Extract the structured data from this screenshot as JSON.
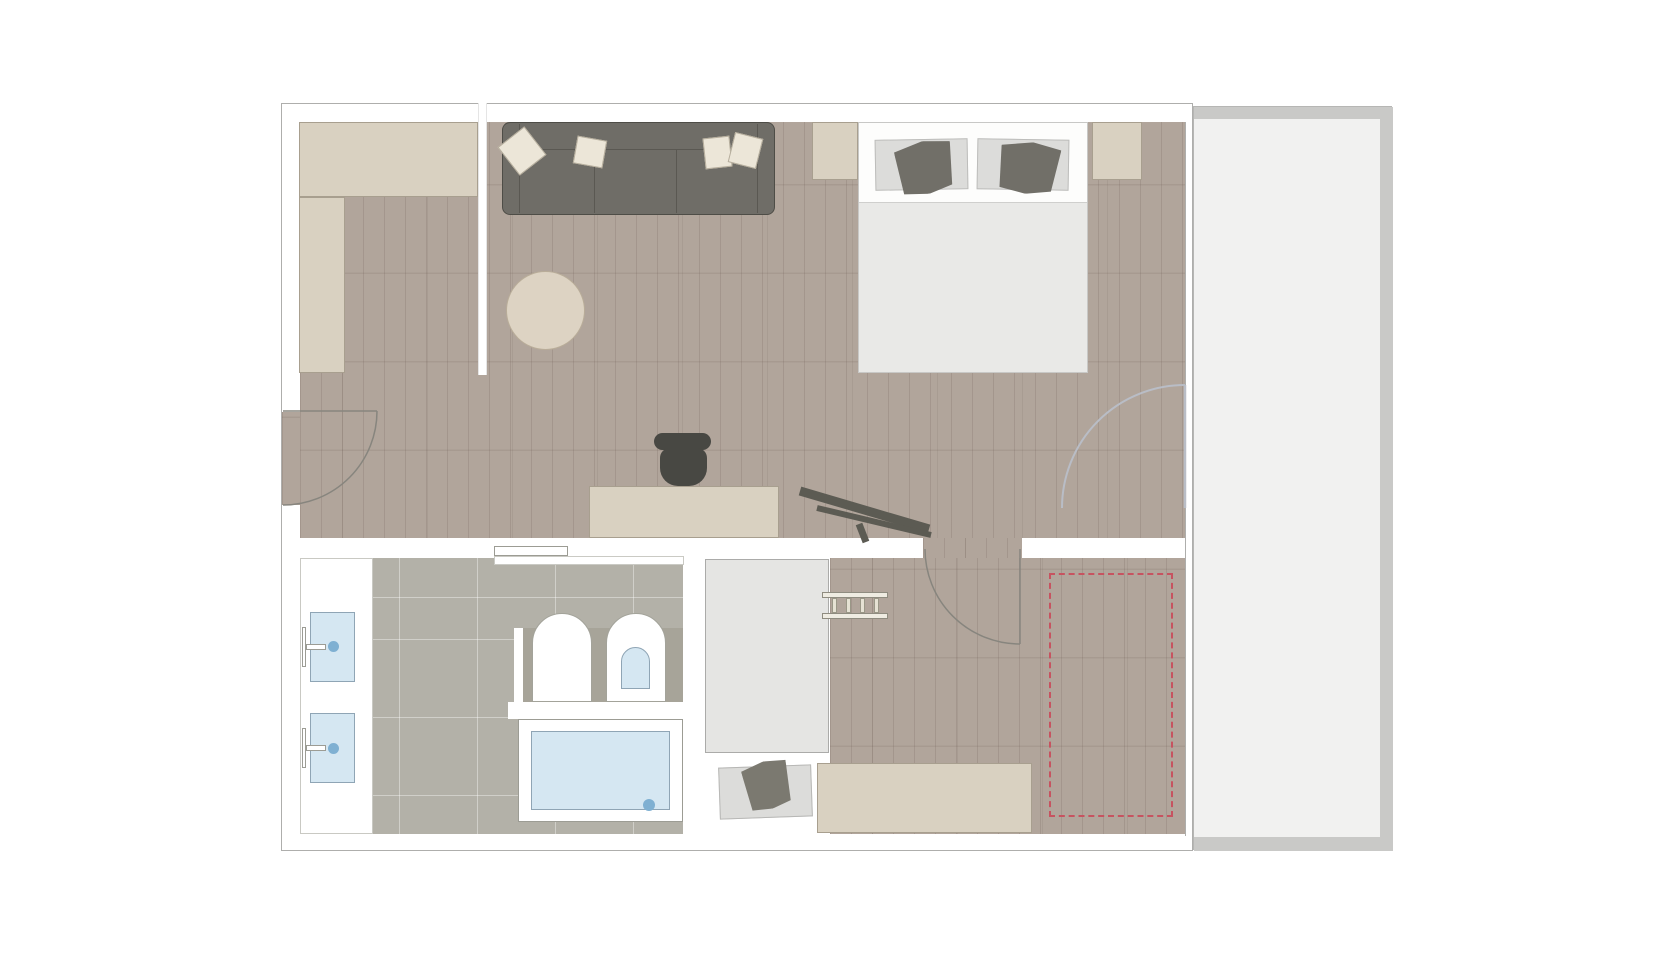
{
  "document": {
    "type": "floor-plan",
    "description": "Top-down architectural floor plan of a one-bedroom suite with living area, bedroom, bathroom, dressing hallway and a full-height balcony on the right; no text labels are rendered in the image."
  },
  "palette": {
    "wall-line": "#aeaeac",
    "wood": "#b1a59b",
    "tile": "#b3b1a8",
    "balcony-floor": "#f1f1f0",
    "railing": "#c9c9c7",
    "beige": "#d9d1c1",
    "beige-line": "#a89f8f",
    "sofa": "#6f6d67",
    "sofa-line": "#4e4d47",
    "pillow-light": "#ece6d8",
    "accent-pillow": "#716f68",
    "bed-white": "#fdfdfc",
    "duvet": "#e9e9e7",
    "pillow-gray": "#dcdcda",
    "water": "#d5e7f2",
    "water-line": "#8fa5b5",
    "drain": "#7fb0d2",
    "fixture-line": "#9c9c94",
    "toilet-block": "#a7a499",
    "chair-dark": "#484843",
    "wardrobe": "#e5e5e3",
    "rug-gray": "#dcdcda",
    "pet-pillow": "#7b7970",
    "rug-round": "#ddd3c3",
    "door-arc": "#87857e",
    "glass-door-arc": "#b9bdc6",
    "dashed-red": "#c75360",
    "lounge-chair": "#5c5b53"
  },
  "rooms": [
    {
      "name": "entry-kitchenette",
      "floor": "wood"
    },
    {
      "name": "living-room",
      "floor": "wood"
    },
    {
      "name": "bedroom",
      "floor": "wood"
    },
    {
      "name": "bathroom",
      "floor": "tile"
    },
    {
      "name": "wardrobe-niche",
      "floor": "white"
    },
    {
      "name": "dressing-hallway",
      "floor": "wood"
    },
    {
      "name": "balcony",
      "floor": "light-gray"
    }
  ],
  "furniture": [
    "l-shaped-counter",
    "sofa-with-four-pillows",
    "round-rug",
    "desk",
    "desk-chair",
    "lounge-chair",
    "double-bed-with-pillows",
    "nightstand-left",
    "nightstand-right",
    "vanity-with-two-sinks",
    "toilet",
    "bidet",
    "bathtub",
    "pocket-door",
    "wardrobe-cabinet",
    "pet-bed",
    "luggage-rack",
    "sideboard",
    "dashed-layout-zone"
  ],
  "doors": [
    {
      "name": "entrance-door",
      "wall": "left",
      "swing": "quarter-arc"
    },
    {
      "name": "bedroom-door",
      "wall": "center-horizontal",
      "swing": "quarter-arc"
    },
    {
      "name": "balcony-door",
      "wall": "right-glass",
      "swing": "quarter-arc"
    }
  ]
}
